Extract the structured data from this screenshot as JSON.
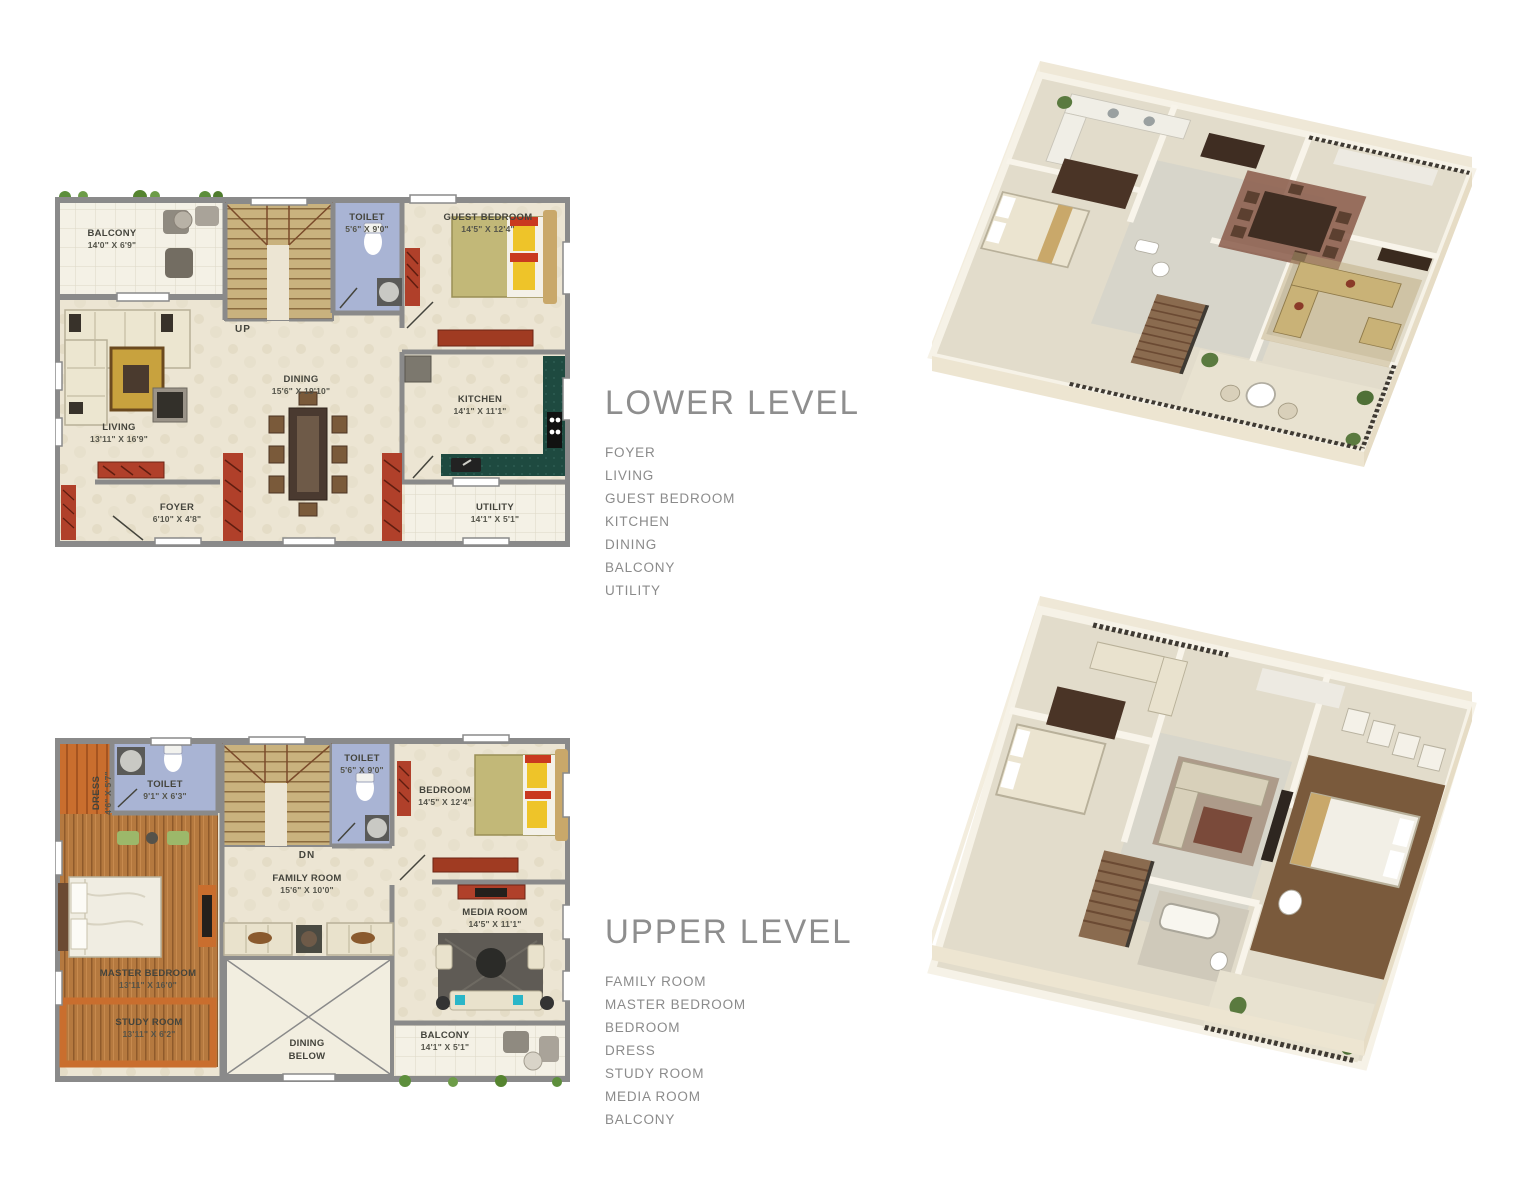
{
  "sections": {
    "lower": {
      "title": "LOWER LEVEL",
      "rooms": [
        "FOYER",
        "LIVING",
        "GUEST BEDROOM",
        "KITCHEN",
        "DINING",
        "BALCONY",
        "UTILITY"
      ]
    },
    "upper": {
      "title": "UPPER LEVEL",
      "rooms": [
        "FAMILY ROOM",
        "MASTER BEDROOM",
        "BEDROOM",
        "DRESS",
        "STUDY ROOM",
        "MEDIA ROOM",
        "BALCONY"
      ]
    }
  },
  "lower_plan": {
    "balcony": {
      "n": "BALCONY",
      "d": "14'0\" X 6'9\""
    },
    "toilet": {
      "n": "TOILET",
      "d": "5'6\" X 9'0\""
    },
    "guest_bedroom": {
      "n": "GUEST BEDROOM",
      "d": "14'5\" X 12'4\""
    },
    "living": {
      "n": "LIVING",
      "d": "13'11\" X 16'9\""
    },
    "dining": {
      "n": "DINING",
      "d": "15'6\" X 19'10\""
    },
    "kitchen": {
      "n": "KITCHEN",
      "d": "14'1\" X 11'1\""
    },
    "foyer": {
      "n": "FOYER",
      "d": "6'10\" X 4'8\""
    },
    "utility": {
      "n": "UTILITY",
      "d": "14'1\" X 5'1\""
    },
    "stairs_label": "UP"
  },
  "upper_plan": {
    "toilet_left": {
      "n": "TOILET",
      "d": "9'1\" X 6'3\""
    },
    "toilet_right": {
      "n": "TOILET",
      "d": "5'6\" X 9'0\""
    },
    "bedroom": {
      "n": "BEDROOM",
      "d": "14'5\" X 12'4\""
    },
    "family_room": {
      "n": "FAMILY ROOM",
      "d": "15'6\" X 10'0\""
    },
    "media_room": {
      "n": "MEDIA ROOM",
      "d": "14'5\" X 11'1\""
    },
    "master_bedroom": {
      "n": "MASTER BEDROOM",
      "d": "13'11\" X 16'0\""
    },
    "study_room": {
      "n": "STUDY ROOM",
      "d": "13'11\" X 6'2\""
    },
    "dress": {
      "n": "DRESS",
      "d": "4'6\" X 5'7\""
    },
    "dining_below_1": "DINING",
    "dining_below_2": "BELOW",
    "balcony": {
      "n": "BALCONY",
      "d": "14'1\" X 5'1\""
    },
    "stairs_label": "DN"
  },
  "colors": {
    "wall": "#8a8a8a",
    "floor": "#ece5d3",
    "toilet_floor": "#a9b4d4",
    "stair": "#c9b27e",
    "wood_floor": "#b5793f",
    "accent_red": "#b0402a",
    "accent_orange": "#c96e2e",
    "counter_green": "#1e4a40",
    "heading_gray": "#8e8e8e",
    "greenery": "#5d8f3c",
    "render_wall": "#efe8d7"
  }
}
